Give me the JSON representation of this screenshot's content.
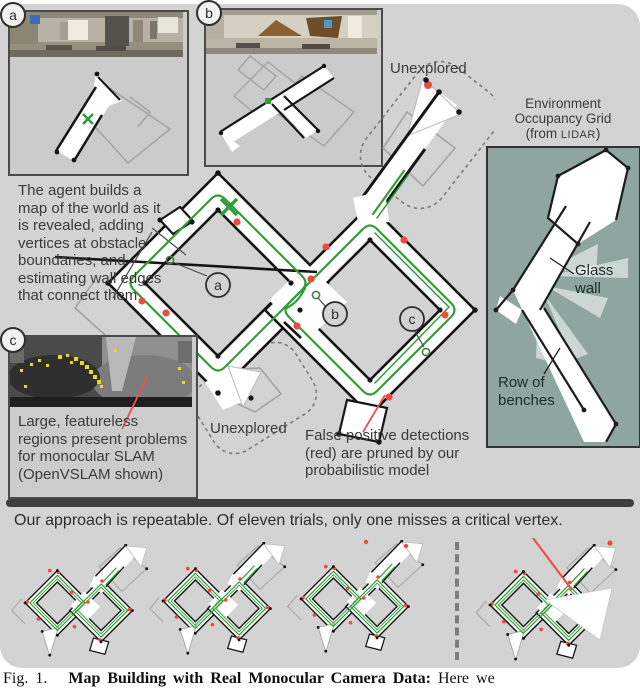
{
  "panels": {
    "a": {
      "badge": "a"
    },
    "b": {
      "badge": "b"
    },
    "c": {
      "badge": "c",
      "note": "Large, featureless regions present problems for monocular SLAM (OpenVSLAM shown)"
    }
  },
  "map_badges": {
    "a": "a",
    "b": "b",
    "c": "c"
  },
  "labels": {
    "unexplored_top": "Unexplored",
    "unexplored_bottom": "Unexplored",
    "env1": "Environment",
    "env2": "Occupancy Grid",
    "env3_pre": "(from ",
    "env3_lidar": "LIDAR",
    "env3_post": ")",
    "agent_note": "The agent builds a map of the world as it is revealed, adding vertices at obstacle boundaries, and estimating wall edges that connect them",
    "glass_wall": "Glass wall",
    "row_of_benches": "Row of benches",
    "false_positive_note": "False positive detections (red) are pruned by our probabilistic model",
    "repeatable_note": "Our approach is repeatable. Of eleven trials, only one misses a critical vertex."
  },
  "caption": {
    "fig": "Fig. 1.",
    "bold": "Map Building with Real Monocular Camera Data:",
    "rest": "Here we"
  },
  "colors": {
    "figure_bg": "#d3d3d3",
    "lidar_panel_bg": "#8ea69f",
    "trajectory_green": "#2f9e38",
    "detection_red": "#ee4b40",
    "wall_black": "#151515",
    "estimated_wall_gray": "#a3a3a3",
    "text": "#3b3b3b"
  }
}
